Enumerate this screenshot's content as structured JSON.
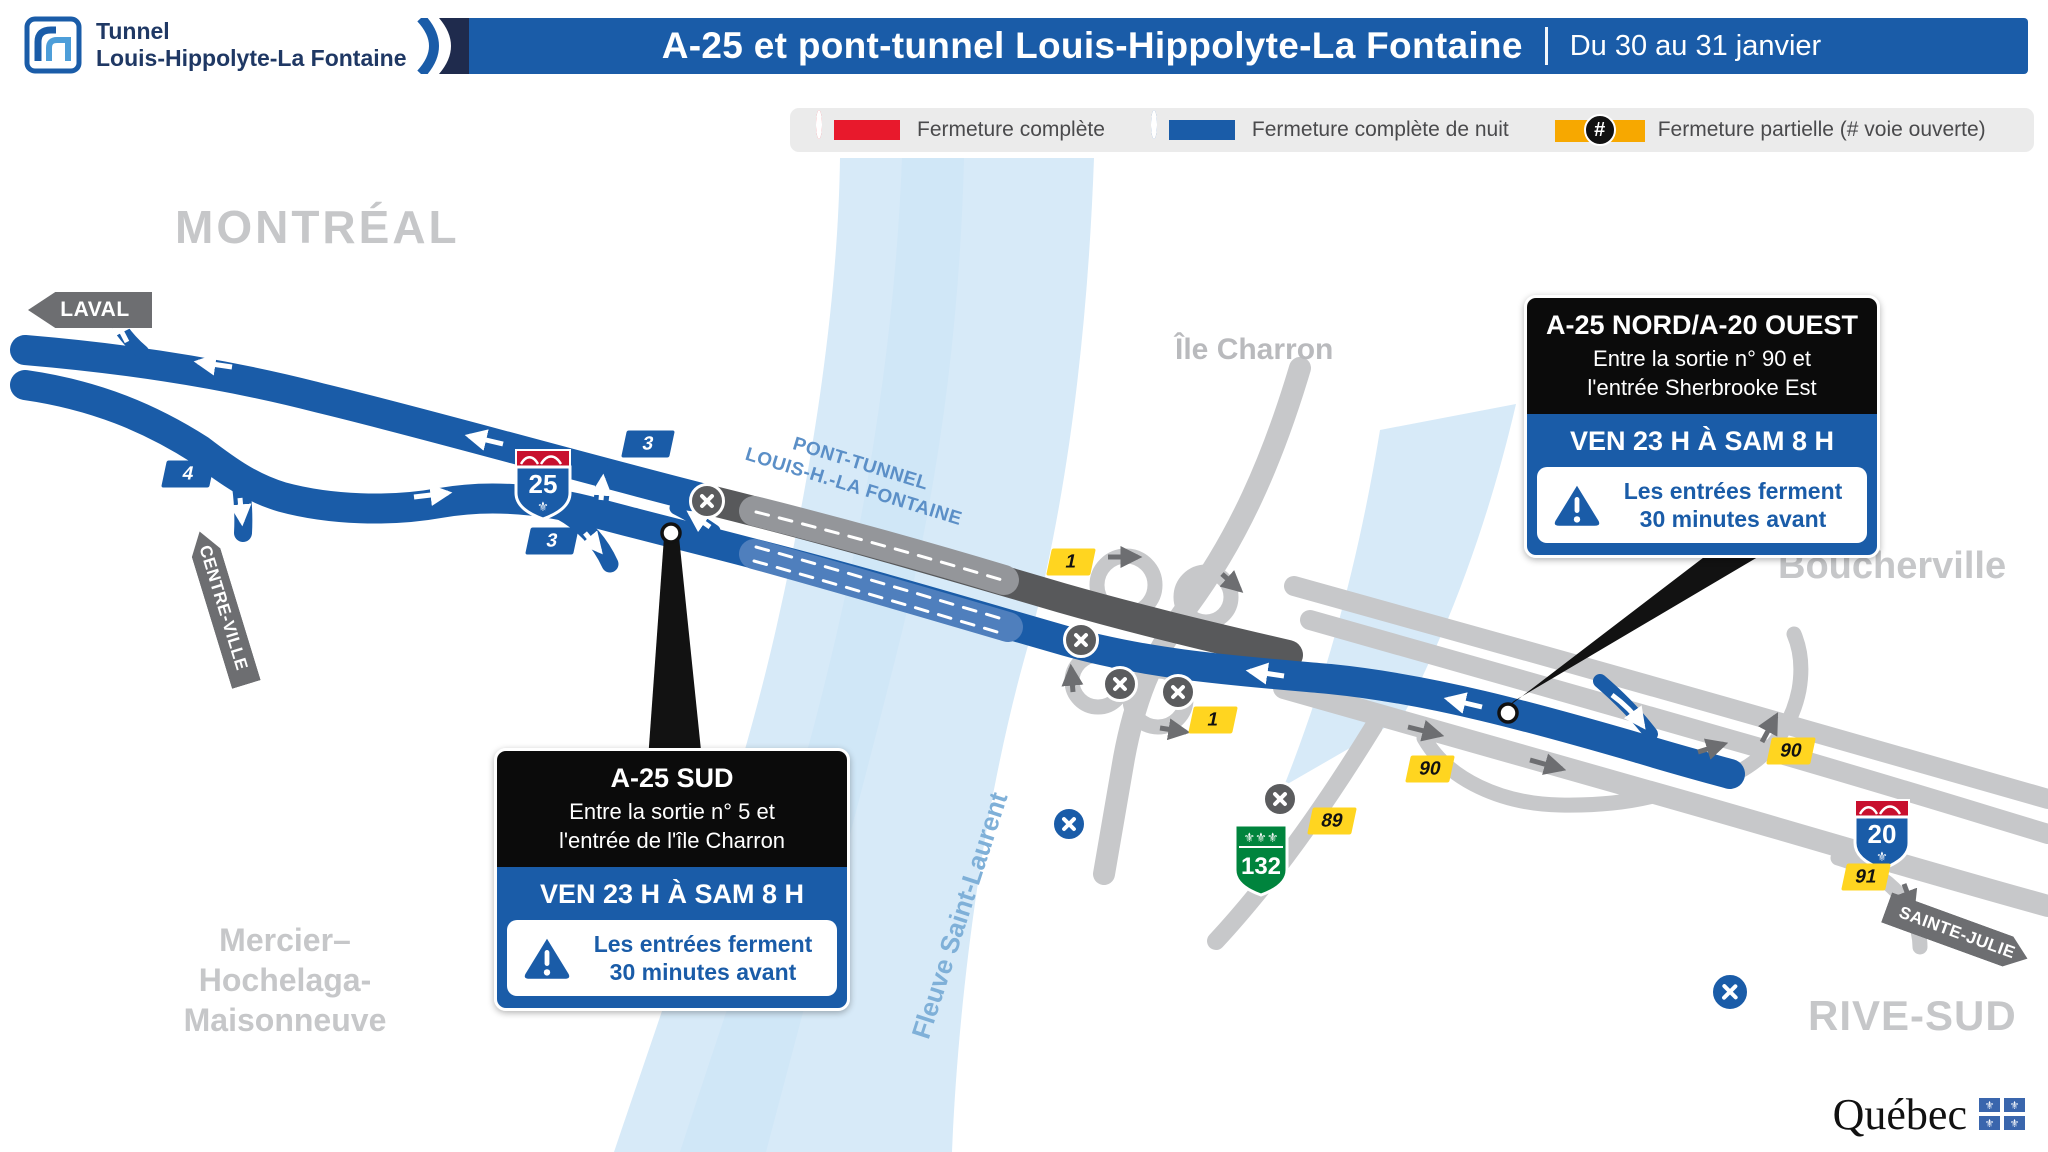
{
  "header": {
    "logo": {
      "line1": "Tunnel",
      "line2": "Louis-Hippolyte-La Fontaine"
    },
    "title": "A-25 et pont-tunnel Louis-Hippolyte-La Fontaine",
    "date_range": "Du 30 au 31 janvier"
  },
  "legend": {
    "items": [
      {
        "label": "Fermeture complète",
        "type": "complete",
        "color": "#E8192C"
      },
      {
        "label": "Fermeture complète de nuit",
        "type": "night",
        "color": "#1A5CA8"
      },
      {
        "label": "Fermeture partielle (# voie ouverte)",
        "type": "partial",
        "color": "#F7A800",
        "symbol": "#"
      }
    ]
  },
  "map": {
    "region_labels": {
      "montreal": "MONTRÉAL",
      "ile_charron": "Île Charron",
      "boucherville": "Boucherville",
      "mercier": [
        "Mercier–",
        "Hochelaga-",
        "Maisonneuve"
      ],
      "rive_sud": "RIVE-SUD",
      "fleuve": "Fleuve Saint-Laurent"
    },
    "tunnel_label": [
      "PONT-TUNNEL",
      "LOUIS-H.-LA FONTAINE"
    ],
    "direction_signs": [
      {
        "id": "laval",
        "label": "LAVAL"
      },
      {
        "id": "centre-ville",
        "label": "CENTRE-VILLE"
      },
      {
        "id": "sainte-julie",
        "label": "SAINTE-JULIE"
      }
    ],
    "route_shields": [
      {
        "id": "a25",
        "number": "25"
      },
      {
        "id": "a20",
        "number": "20"
      },
      {
        "id": "r132",
        "number": "132"
      }
    ],
    "exit_badges": {
      "b4": "4",
      "b3_upper": "3",
      "b3_lower": "3",
      "y1_north": "1",
      "y1_south": "1",
      "y90_west": "90",
      "y89": "89",
      "y90_east": "90",
      "y91": "91"
    }
  },
  "callouts": [
    {
      "id": "a25-sud",
      "title": "A-25 SUD",
      "line1": "Entre la sortie n° 5 et",
      "line2": "l'entrée de l'île Charron",
      "schedule": "VEN 23 H À SAM 8 H",
      "warning_line1": "Les entrées ferment",
      "warning_line2": "30 minutes avant"
    },
    {
      "id": "a25-nord-a20-ouest",
      "title": "A-25 NORD/A-20 OUEST",
      "line1": "Entre la sortie n° 90 et",
      "line2": "l'entrée Sherbrooke Est",
      "schedule": "VEN 23 H À SAM 8 H",
      "warning_line1": "Les entrées ferment",
      "warning_line2": "30 minutes avant"
    }
  ],
  "footer": {
    "wordmark": "Québec"
  },
  "colors": {
    "road_blue": "#1A5CA8",
    "road_dark": "#58595B",
    "road_light": "#C7C8CA",
    "water": "#D7EAF8",
    "closure_red": "#E8192C",
    "partial_orange": "#F7A800",
    "exit_yellow": "#FFD520",
    "sign_gray": "#6D6E71",
    "navy": "#1F2B4D",
    "green_132": "#00843D",
    "label_gray": "#C6C7C9"
  }
}
